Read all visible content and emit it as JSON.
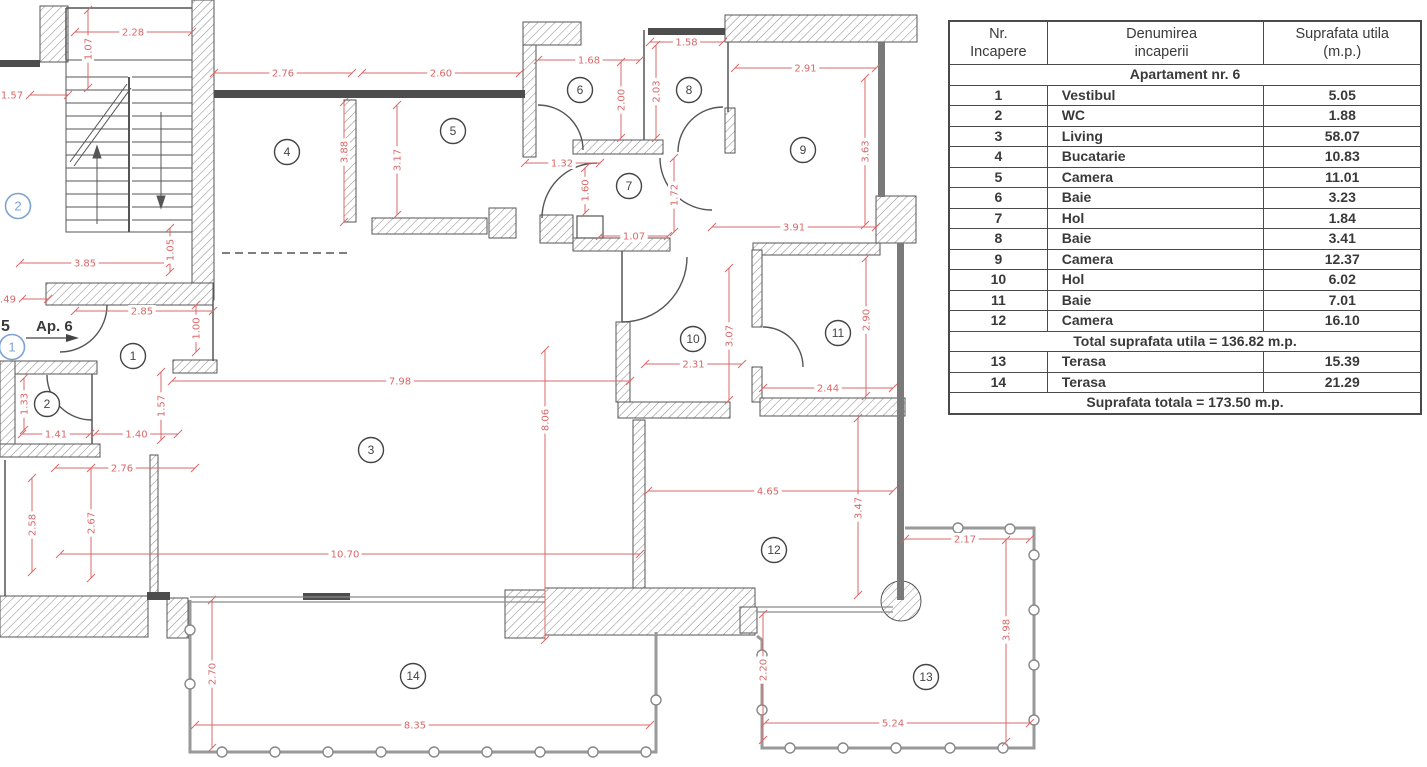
{
  "table": {
    "headers": [
      "Nr.\nIncapere",
      "Denumirea\nincaperii",
      "Suprafata utila\n(m.p.)"
    ],
    "section_title": "Apartament nr. 6",
    "rows": [
      {
        "nr": "1",
        "name": "Vestibul",
        "area": "5.05"
      },
      {
        "nr": "2",
        "name": "WC",
        "area": "1.88"
      },
      {
        "nr": "3",
        "name": "Living",
        "area": "58.07"
      },
      {
        "nr": "4",
        "name": "Bucatarie",
        "area": "10.83"
      },
      {
        "nr": "5",
        "name": "Camera",
        "area": "11.01"
      },
      {
        "nr": "6",
        "name": "Baie",
        "area": "3.23"
      },
      {
        "nr": "7",
        "name": "Hol",
        "area": "1.84"
      },
      {
        "nr": "8",
        "name": "Baie",
        "area": "3.41"
      },
      {
        "nr": "9",
        "name": "Camera",
        "area": "12.37"
      },
      {
        "nr": "10",
        "name": "Hol",
        "area": "6.02"
      },
      {
        "nr": "11",
        "name": "Baie",
        "area": "7.01"
      },
      {
        "nr": "12",
        "name": "Camera",
        "area": "16.10"
      }
    ],
    "total_row": "Total suprafata utila = 136.82  m.p.",
    "terrace_rows": [
      {
        "nr": "13",
        "name": "Terasa",
        "area": "15.39"
      },
      {
        "nr": "14",
        "name": "Terasa",
        "area": "21.29"
      }
    ],
    "grand_total_row": "Suprafata totala = 173.50 m.p."
  },
  "plan": {
    "apartment_label": "Ap. 6",
    "adjacent_label_partial": "5",
    "room_markers": [
      {
        "n": "1",
        "x": 133,
        "y": 356
      },
      {
        "n": "2",
        "x": 47,
        "y": 404
      },
      {
        "n": "3",
        "x": 371,
        "y": 450
      },
      {
        "n": "4",
        "x": 287,
        "y": 152
      },
      {
        "n": "5",
        "x": 453,
        "y": 131
      },
      {
        "n": "6",
        "x": 580,
        "y": 90
      },
      {
        "n": "7",
        "x": 629,
        "y": 186
      },
      {
        "n": "8",
        "x": 689,
        "y": 90
      },
      {
        "n": "9",
        "x": 803,
        "y": 150
      },
      {
        "n": "10",
        "x": 693,
        "y": 339
      },
      {
        "n": "11",
        "x": 838,
        "y": 333
      },
      {
        "n": "12",
        "x": 774,
        "y": 550
      },
      {
        "n": "13",
        "x": 926,
        "y": 677
      },
      {
        "n": "14",
        "x": 413,
        "y": 676
      }
    ],
    "entry_markers": [
      {
        "n": "1",
        "x": 12,
        "y": 347
      },
      {
        "n": "2",
        "x": 18,
        "y": 206
      }
    ],
    "dimensions": [
      {
        "t": "2.28",
        "o": "h",
        "y": 32,
        "x1": 75,
        "x2": 192,
        "lx": 133
      },
      {
        "t": "1.07",
        "o": "v",
        "x": 88,
        "y1": 10,
        "y2": 88
      },
      {
        "t": "1.57",
        "o": "h",
        "y": 95,
        "x1": 30,
        "x2": 68,
        "lx": 12
      },
      {
        "t": "2.76",
        "o": "h",
        "y": 73,
        "x1": 214,
        "x2": 352
      },
      {
        "t": "2.60",
        "o": "h",
        "y": 73,
        "x1": 362,
        "x2": 520
      },
      {
        "t": "1.68",
        "o": "h",
        "y": 60,
        "x1": 538,
        "x2": 640
      },
      {
        "t": "1.58",
        "o": "h",
        "y": 42,
        "x1": 650,
        "x2": 723
      },
      {
        "t": "2.91",
        "o": "h",
        "y": 68,
        "x1": 735,
        "x2": 876
      },
      {
        "t": "2.00",
        "o": "v",
        "x": 621,
        "y1": 62,
        "y2": 138
      },
      {
        "t": "2.03",
        "o": "v",
        "x": 656,
        "y1": 45,
        "y2": 138
      },
      {
        "t": "3.63",
        "o": "v",
        "x": 865,
        "y1": 78,
        "y2": 225
      },
      {
        "t": "3.88",
        "o": "v",
        "x": 344,
        "y1": 102,
        "y2": 222,
        "ly": 152
      },
      {
        "t": "3.17",
        "o": "v",
        "x": 397,
        "y1": 105,
        "y2": 215
      },
      {
        "t": "1.32",
        "o": "h",
        "y": 163,
        "x1": 525,
        "x2": 600,
        "lx": 562
      },
      {
        "t": "1.60",
        "o": "v",
        "x": 585,
        "y1": 168,
        "y2": 213
      },
      {
        "t": "1.72",
        "o": "v",
        "x": 674,
        "y1": 158,
        "y2": 232
      },
      {
        "t": "1.07",
        "o": "h",
        "y": 236,
        "x1": 600,
        "x2": 668
      },
      {
        "t": "3.91",
        "o": "h",
        "y": 227,
        "x1": 712,
        "x2": 876
      },
      {
        "t": "3.85",
        "o": "h",
        "y": 263,
        "x1": 20,
        "x2": 170,
        "lx": 85
      },
      {
        "t": ".49",
        "o": "h",
        "y": 299,
        "x1": 22,
        "x2": 48,
        "lx": 8
      },
      {
        "t": "2.85",
        "o": "h",
        "y": 311,
        "x1": 75,
        "x2": 213,
        "lx": 142
      },
      {
        "t": "1.05",
        "o": "v",
        "x": 170,
        "y1": 228,
        "y2": 272
      },
      {
        "t": "1.00",
        "o": "v",
        "x": 196,
        "y1": 305,
        "y2": 352
      },
      {
        "t": "1.33",
        "o": "v",
        "x": 24,
        "y1": 378,
        "y2": 430
      },
      {
        "t": "1.57",
        "o": "v",
        "x": 161,
        "y1": 372,
        "y2": 440
      },
      {
        "t": "1.41",
        "o": "h",
        "y": 434,
        "x1": 22,
        "x2": 90
      },
      {
        "t": "1.40",
        "o": "h",
        "y": 434,
        "x1": 95,
        "x2": 178
      },
      {
        "t": "2.76",
        "o": "h",
        "y": 468,
        "x1": 55,
        "x2": 195,
        "lx": 122
      },
      {
        "t": "2.58",
        "o": "v",
        "x": 32,
        "y1": 478,
        "y2": 572
      },
      {
        "t": "2.67",
        "o": "v",
        "x": 91,
        "y1": 468,
        "y2": 578
      },
      {
        "t": "7.98",
        "o": "h",
        "y": 381,
        "x1": 172,
        "x2": 630,
        "lx": 400
      },
      {
        "t": "8.06",
        "o": "v",
        "x": 545,
        "y1": 350,
        "y2": 640,
        "ly": 420
      },
      {
        "t": "10.70",
        "o": "h",
        "y": 554,
        "x1": 60,
        "x2": 640,
        "lx": 345
      },
      {
        "t": "2.31",
        "o": "h",
        "y": 364,
        "x1": 645,
        "x2": 742
      },
      {
        "t": "3.07",
        "o": "v",
        "x": 729,
        "y1": 268,
        "y2": 400,
        "ly": 336
      },
      {
        "t": "2.44",
        "o": "h",
        "y": 388,
        "x1": 763,
        "x2": 893
      },
      {
        "t": "2.90",
        "o": "v",
        "x": 866,
        "y1": 258,
        "y2": 396,
        "ly": 320
      },
      {
        "t": "4.65",
        "o": "h",
        "y": 491,
        "x1": 648,
        "x2": 893,
        "lx": 768
      },
      {
        "t": "3.47",
        "o": "v",
        "x": 858,
        "y1": 418,
        "y2": 595,
        "ly": 508
      },
      {
        "t": "2.17",
        "o": "h",
        "y": 539,
        "x1": 905,
        "x2": 1030,
        "lx": 965
      },
      {
        "t": "3.98",
        "o": "v",
        "x": 1006,
        "y1": 540,
        "y2": 742,
        "ly": 630
      },
      {
        "t": "2.20",
        "o": "v",
        "x": 763,
        "y1": 614,
        "y2": 740,
        "ly": 670
      },
      {
        "t": "5.24",
        "o": "h",
        "y": 723,
        "x1": 765,
        "x2": 1030,
        "lx": 893
      },
      {
        "t": "2.70",
        "o": "v",
        "x": 212,
        "y1": 600,
        "y2": 748,
        "ly": 674
      },
      {
        "t": "8.35",
        "o": "h",
        "y": 725,
        "x1": 195,
        "x2": 650,
        "lx": 415
      }
    ]
  },
  "colors": {
    "dimension": "#d96868",
    "wall_line": "#555555",
    "entry_marker": "#7ba3d6",
    "text": "#3a3a3a"
  }
}
